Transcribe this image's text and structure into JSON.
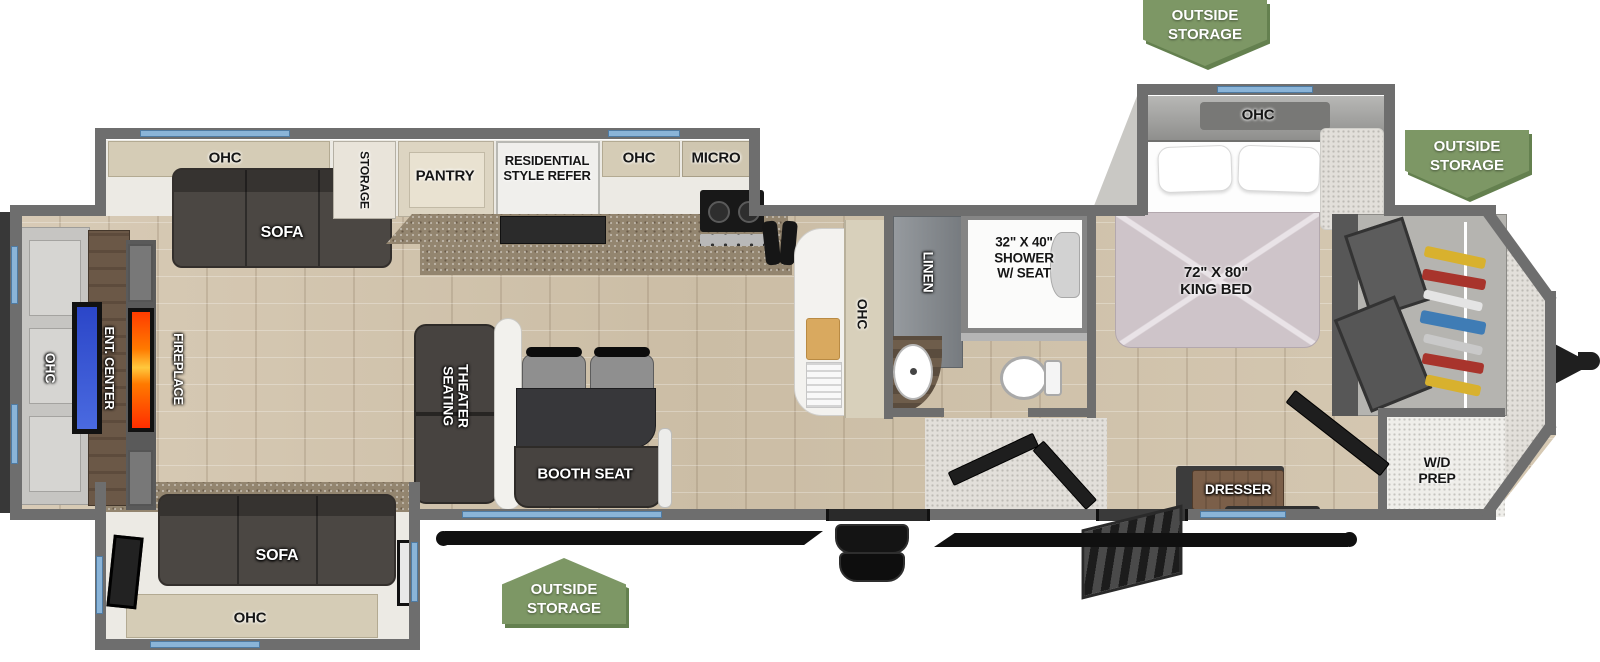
{
  "diagram_type": "travel-trailer-floorplan",
  "badges": {
    "outside_storage": {
      "line1": "OUTSIDE",
      "line2": "STORAGE"
    }
  },
  "labels": {
    "rear_ohc": "OHC",
    "ent_center": "ENT. CENTER",
    "fireplace": "FIREPLACE",
    "slideout_ohc": "OHC",
    "slideout_sofa": "SOFA",
    "storage": "STORAGE",
    "pantry": "PANTRY",
    "refer_line1": "RESIDENTIAL",
    "refer_line2": "STYLE REFER",
    "kitchen_ohc": "OHC",
    "micro": "MICRO",
    "peninsula_ohc": "OHC",
    "linen": "LINEN",
    "shower_line1": "32\" X 40\"",
    "shower_line2": "SHOWER",
    "shower_line3": "W/ SEAT",
    "bedroom_ohc": "OHC",
    "bed_line1": "72\" X 80\"",
    "bed_line2": "KING BED",
    "dresser": "DRESSER",
    "wd_line1": "W/D",
    "wd_line2": "PREP",
    "theater_line1": "THEATER",
    "theater_line2": "SEATING",
    "booth_seat": "BOOTH SEAT",
    "rear_sofa": "SOFA",
    "rear_sofa_ohc": "OHC"
  },
  "colors": {
    "badge_green": "#7d9765",
    "wall_gray": "#6e6e6e",
    "window_blue": "#8ab4d8",
    "floor_wood": "#d2c4ae",
    "tv_blue": "#3a57d8",
    "flame_orange": "#ff7a00"
  }
}
